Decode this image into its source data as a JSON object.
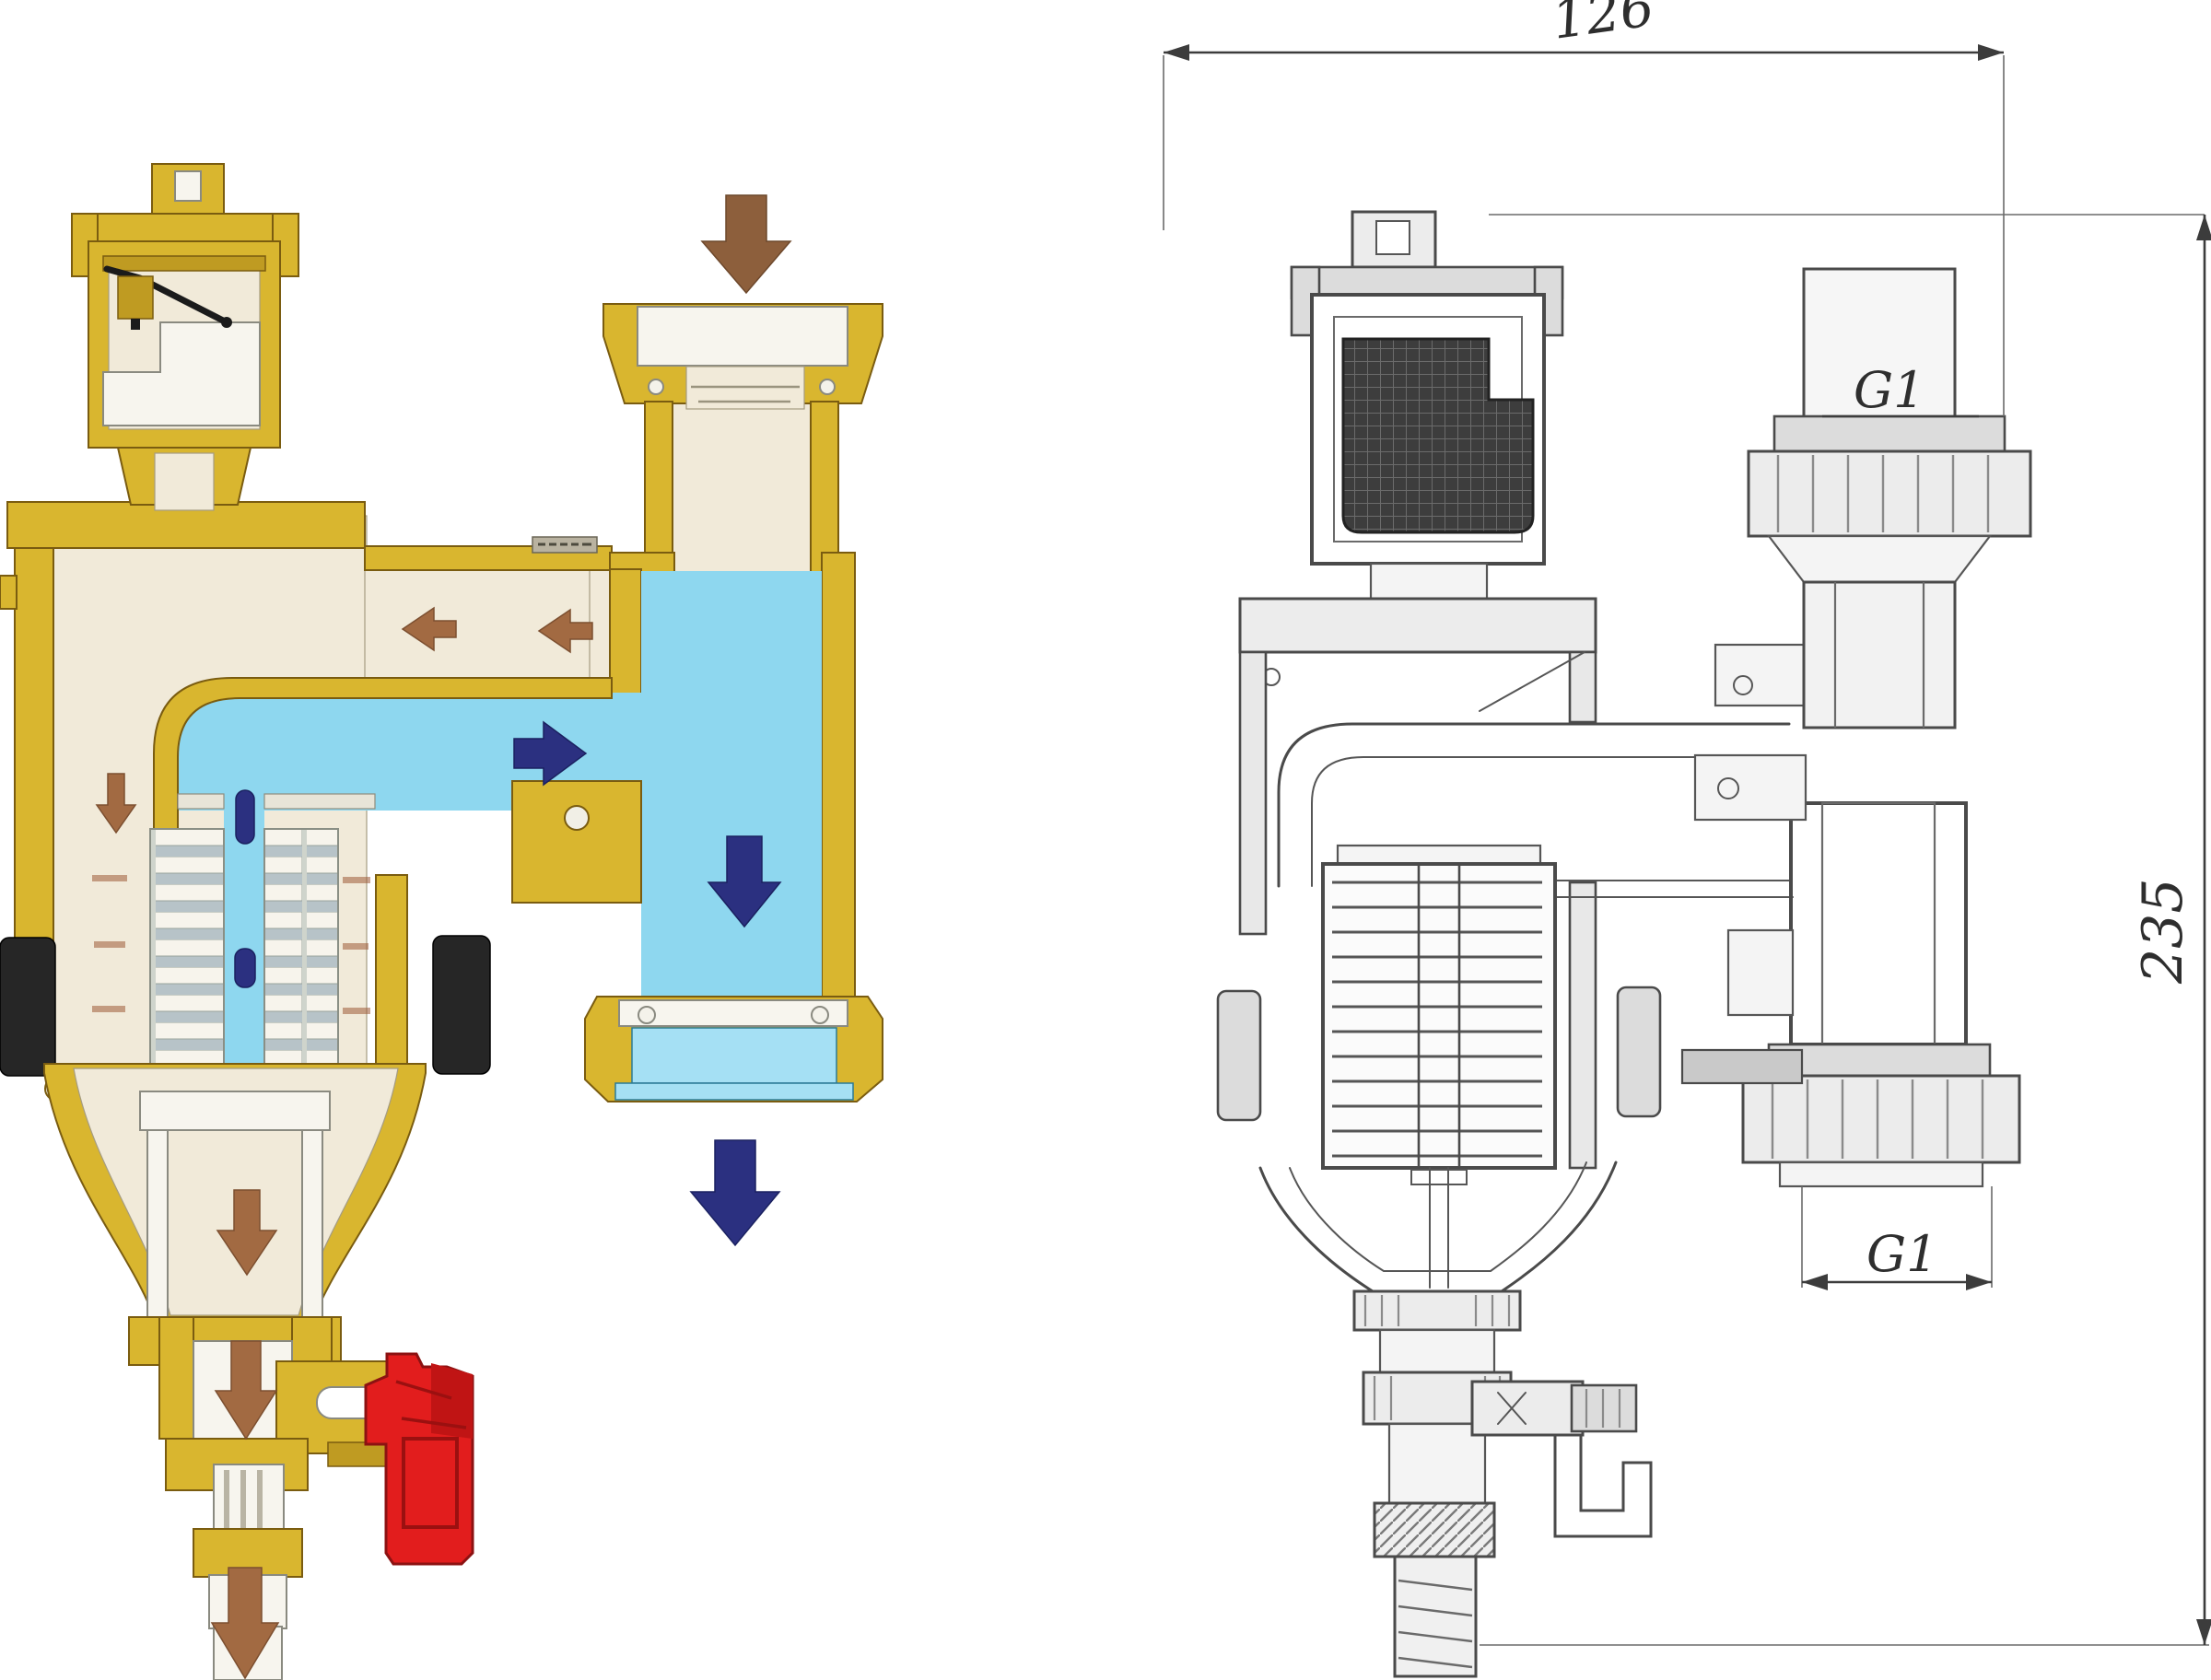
{
  "figure": {
    "type": "valve-cross-section-comparison",
    "subject": "magnetic filter dirt separator valve: colored flow cutaway (left) and dimensioned technical drawing (right)",
    "panels": {
      "left": {
        "style": "colored cutaway flow diagram",
        "components": [
          "air-vent-chamber",
          "float",
          "inlet-union",
          "flow-channel",
          "magnet-rods",
          "filter-plate-stacks",
          "side-seals",
          "settling-bowl",
          "sight-glass-union",
          "drain-valve",
          "red-drain-handle"
        ],
        "flow_arrows": [
          {
            "name": "inlet-flow-down-arrow",
            "direction": "down",
            "color": "#8d5f3c"
          },
          {
            "name": "bypass-flow-left-arrow-1",
            "direction": "left",
            "color": "#a26a42"
          },
          {
            "name": "bypass-flow-left-arrow-2",
            "direction": "left",
            "color": "#a26a42"
          },
          {
            "name": "body-seep-down-arrow",
            "direction": "down",
            "color": "#a26a42"
          },
          {
            "name": "clean-flow-right-arrow",
            "direction": "right",
            "color": "#2b3080"
          },
          {
            "name": "clean-flow-down-arrow",
            "direction": "down",
            "color": "#2b3080"
          },
          {
            "name": "outlet-flow-down-arrow",
            "direction": "down",
            "color": "#2b3080"
          },
          {
            "name": "sediment-settle-down-arrow",
            "direction": "down",
            "color": "#a26a42"
          },
          {
            "name": "drain-flow-down-arrow",
            "direction": "down",
            "color": "#a26a42"
          },
          {
            "name": "drain-discharge-down-arrow",
            "direction": "down",
            "color": "#a26a42"
          }
        ],
        "colors": {
          "brass": "#d9b62f",
          "brass_dark": "#bf9b22",
          "body_cream": "#f1ead9",
          "water_cyan": "#8ed7ef",
          "magnet_navy": "#2b3080",
          "arrow_brown": "#a26a42",
          "drain_handle_red": "#e21d1d",
          "seal_black": "#262626"
        }
      },
      "right": {
        "style": "dimensioned line drawing",
        "line_color": "#4a4a4a",
        "labels": {
          "width_dim": "126",
          "height_dim": "235",
          "top_port": "G1",
          "bottom_port": "G1"
        }
      }
    }
  }
}
